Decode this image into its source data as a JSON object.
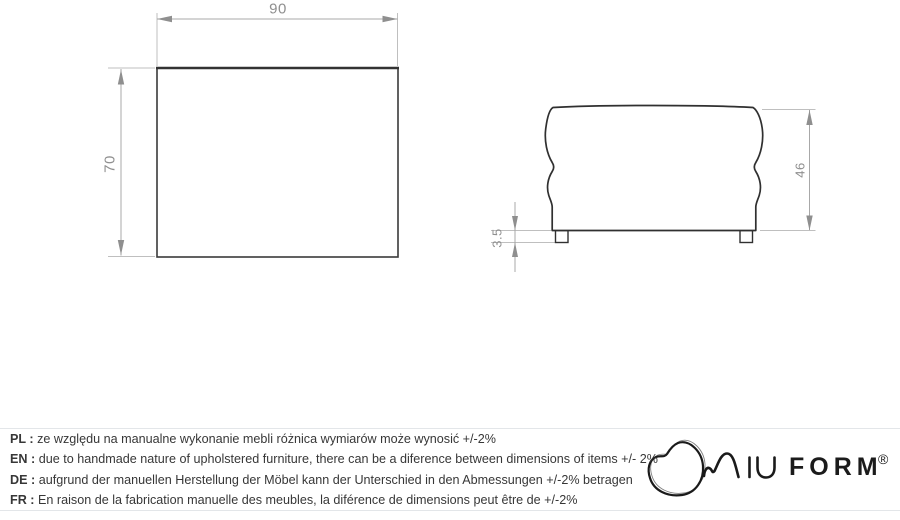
{
  "drawing": {
    "top_view": {
      "width_label": "90",
      "depth_label": "70"
    },
    "side_view": {
      "height_label": "46",
      "leg_height_label": "3.5"
    }
  },
  "notes": {
    "separator": " : ",
    "items": [
      {
        "lang": "PL",
        "text": "ze względu na manualne wykonanie mebli różnica wymiarów może wynosić +/-2%"
      },
      {
        "lang": "EN",
        "text": "due to handmade nature of upholstered furniture, there can be a diference between dimensions of items +/- 2%"
      },
      {
        "lang": "DE",
        "text": "aufgrund der manuellen Herstellung der Möbel kann der Unterschied in den Abmessungen +/-2% betragen"
      },
      {
        "lang": "FR",
        "text": "En raison de la fabrication manuelle des meubles, la diférence de dimensions peut être de +/-2%"
      }
    ]
  },
  "brand": {
    "name": "MIUFORM",
    "wordmark_stylized": "MIU",
    "wordmark_bold": "FORM",
    "registered": "®"
  },
  "colors": {
    "outline": "#333333",
    "dimension_line": "#a8a8a8",
    "extension_line": "#bfbfbf",
    "arrow": "#8f8f8f",
    "dimension_text": "#8f8f8f",
    "note_text": "#373737",
    "rule": "#e3e6e9",
    "logo": "#1a1a1a"
  }
}
